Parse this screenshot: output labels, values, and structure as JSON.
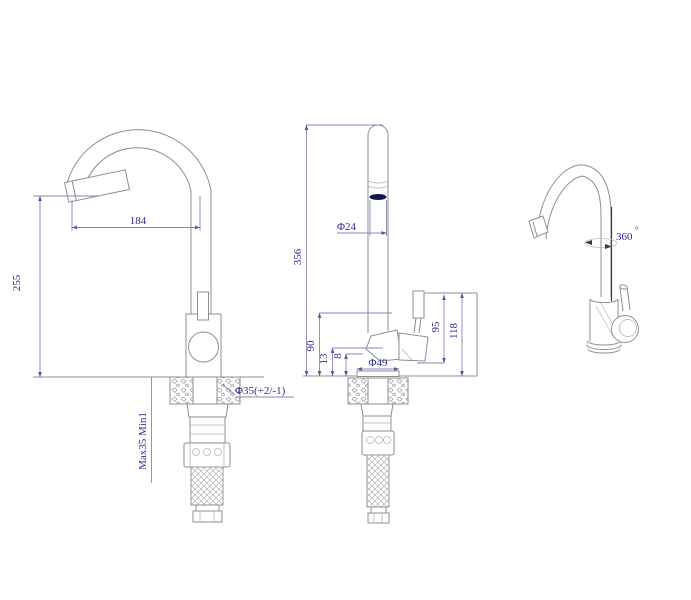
{
  "drawing": {
    "subject": "kitchen-faucet-three-view-technical-drawing",
    "colors": {
      "background": "#ffffff",
      "outline": "#8f8f8f",
      "dimension_line": "#8585bb",
      "dimension_text": "#2e2e96",
      "rotation_axis": "#3a3a3a",
      "aerator_fill": "#15154d"
    },
    "dims": {
      "side_reach": "184",
      "side_height": "255",
      "side_mount": "Max35 Min1",
      "side_hole": "Φ35(+2/-1)",
      "front_height": "356",
      "front_spout": "Φ24",
      "front_body": "90",
      "front_13": "13",
      "front_8": "8",
      "front_base": "Φ49",
      "front_95": "95",
      "front_118": "118",
      "rotation": "360",
      "degree": "°"
    }
  }
}
